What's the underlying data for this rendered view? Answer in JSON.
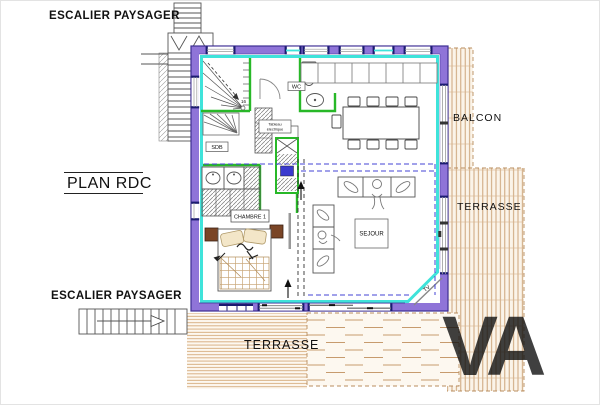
{
  "labels": {
    "escalier_top": "ESCALIER PAYSAGER",
    "plan_title": "PLAN RDC",
    "escalier_bottom": "ESCALIER PAYSAGER",
    "balcon": "BALCON",
    "terrasse_right": "TERRASSE",
    "terrasse_bottom": "TERRASSE",
    "sejour": "SEJOUR",
    "chambre1": "CHAMBRE 1",
    "wc": "WC",
    "sdb": "SDB",
    "tv": "TV",
    "stair_step_count": "16",
    "tech_box_line1": "Tableau",
    "tech_box_line2": "électrique",
    "watermark": "VA"
  },
  "colors": {
    "wall": "#8f74d8",
    "wall_outline": "#3d2e92",
    "interior_face_cyan": "#3fe3da",
    "partition_green": "#28b828",
    "deck_line_tan": "#c79b6e",
    "upper_floor_dash_blue": "#4343d6",
    "window_frame_navy": "#1b1b70"
  }
}
